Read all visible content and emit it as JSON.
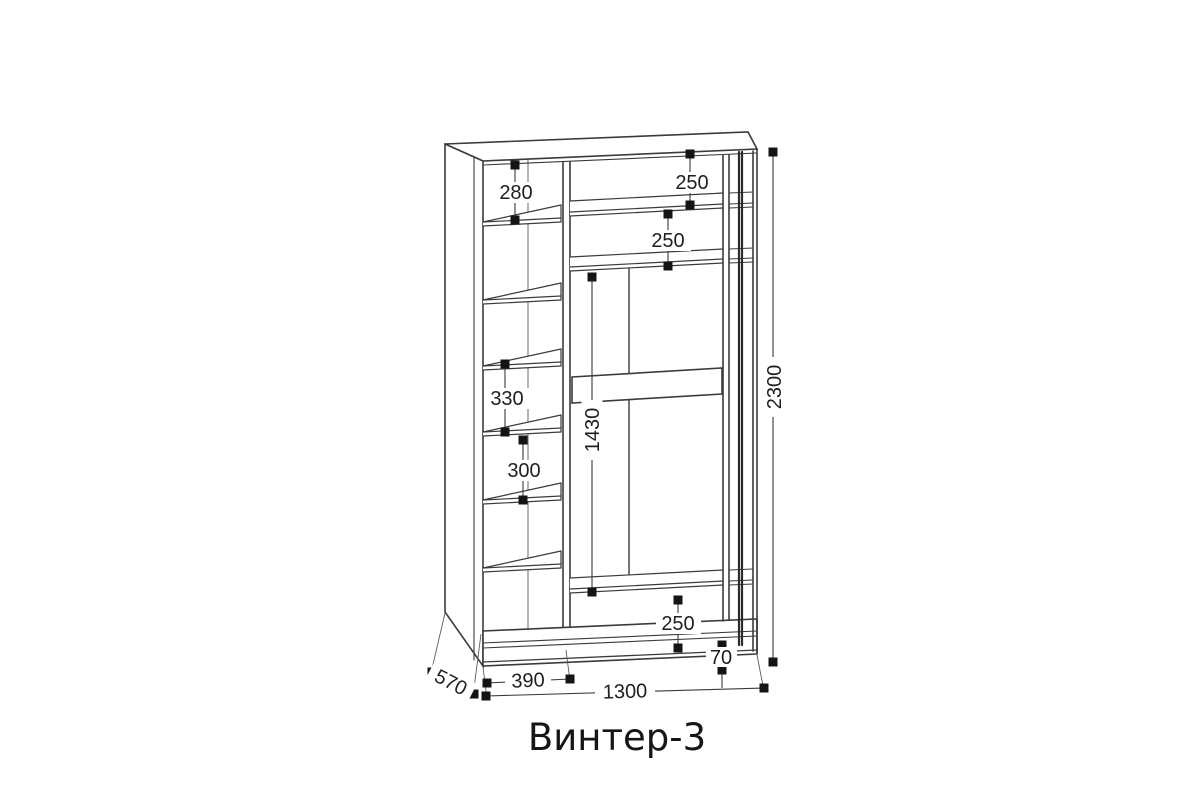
{
  "title": "Винтер-3",
  "colors": {
    "background": "#ffffff",
    "carcass_line": "#3b3b3b",
    "thin_line": "#4a4a4a",
    "door_track_line": "#2b2b2b",
    "dimension_line": "#3a3a3a",
    "marker": "#141414",
    "text": "#1f1f1f"
  },
  "dimensions": {
    "left_top_gap": "280",
    "main_top_gap": "250",
    "main_second_gap": "250",
    "left_middle_gap": "330",
    "left_lower_gap": "300",
    "hanging_height": "1430",
    "total_height": "2300",
    "bottom_gap": "250",
    "base_height": "70",
    "left_column_width": "390",
    "depth": "570",
    "total_width": "1300"
  }
}
